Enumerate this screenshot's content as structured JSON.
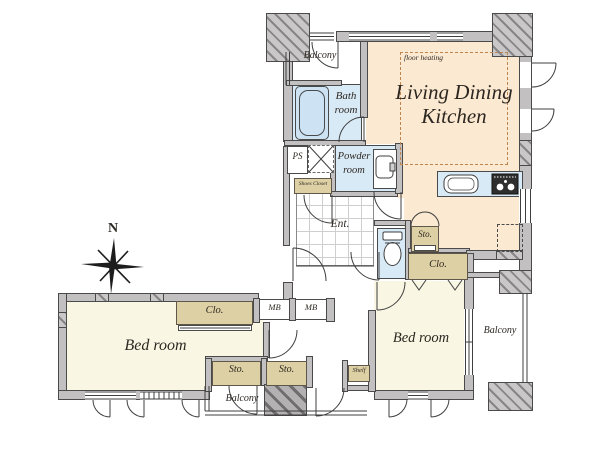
{
  "title": "apartment floor plan",
  "compass": {
    "north": "N"
  },
  "rooms": {
    "living_dining_kitchen": {
      "line1": "Living Dining",
      "line2": "Kitchen",
      "floor_note": "floor heating"
    },
    "bath_room": {
      "line1": "Bath",
      "line2": "room"
    },
    "powder_room": {
      "line1": "Powder",
      "line2": "room"
    },
    "entrance": {
      "label": "Ent."
    },
    "bedroom_left": {
      "label": "Bed room"
    },
    "bedroom_right": {
      "label": "Bed room"
    },
    "balcony_top": {
      "label": "Balcony"
    },
    "balcony_right": {
      "label": "Balcony"
    },
    "balcony_bottom": {
      "label": "Balcony"
    }
  },
  "storage_labels": {
    "closet": "Clo.",
    "storage": "Sto.",
    "meter_box": "MB",
    "pipe_shaft": "PS",
    "shoes_closet": "Shoes Closet",
    "shelf": "Shelf"
  },
  "colors": {
    "wall": "#c2c0c0",
    "ldk_floor": "#fbe9d1",
    "bedroom_floor": "#f9f7e3",
    "wet_area_floor": "#d9eaf7",
    "storage_fill": "#ddd0a4",
    "outline": "#4a4a4a",
    "floor_heating_dash": "#c0854f"
  }
}
